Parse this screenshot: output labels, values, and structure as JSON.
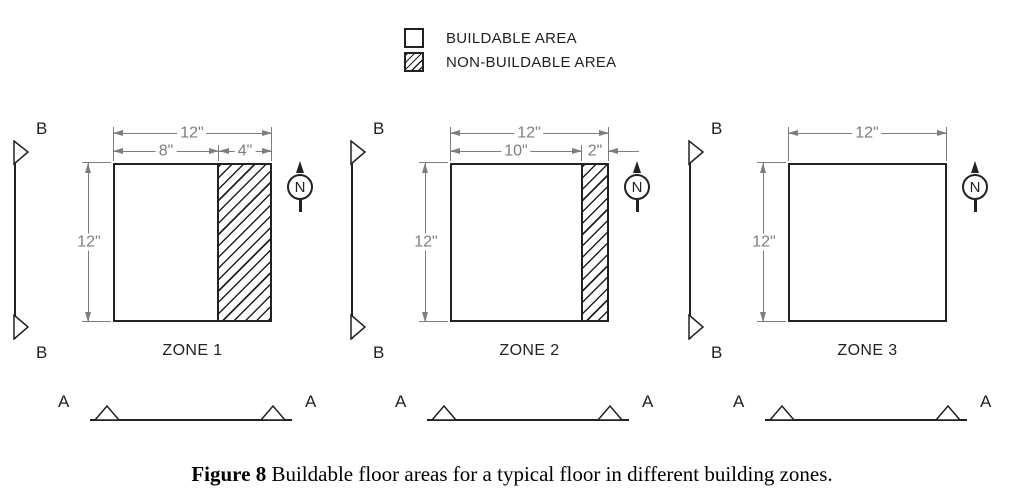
{
  "legend": {
    "items": [
      {
        "label": "BUILDABLE AREA"
      },
      {
        "label": "NON-BUILDABLE AREA"
      }
    ]
  },
  "zones": [
    {
      "name": "ZONE 1",
      "dim_total": "12\"",
      "dim_buildable": "8\"",
      "dim_nonbuildable": "4\"",
      "dim_height": "12\""
    },
    {
      "name": "ZONE 2",
      "dim_total": "12\"",
      "dim_buildable": "10\"",
      "dim_nonbuildable": "2\"",
      "dim_height": "12\""
    },
    {
      "name": "ZONE 3",
      "dim_total": "12\"",
      "dim_height": "12\""
    }
  ],
  "markers": {
    "section_b": "B",
    "section_a": "A",
    "north": "N"
  },
  "caption": {
    "label": "Figure 8",
    "text": " Buildable floor areas for a typical floor in different building zones."
  },
  "colors": {
    "dimension_gray": "#7d7d7d",
    "line_color": "#222222"
  }
}
